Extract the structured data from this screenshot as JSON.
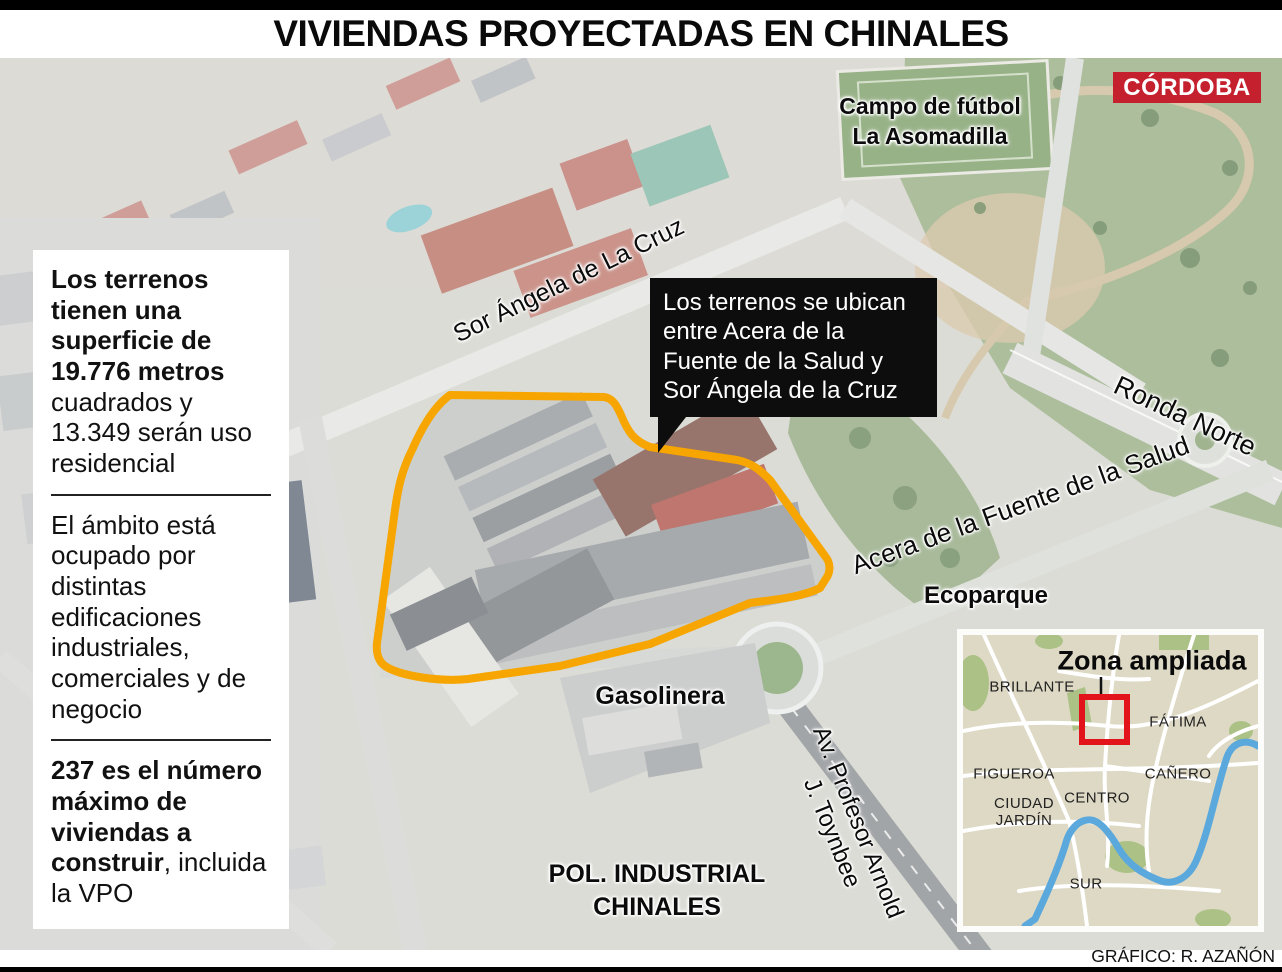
{
  "header": {
    "title": "VIVIENDAS PROYECTADAS EN CHINALES"
  },
  "brand": {
    "name": "CÓRDOBA",
    "bg_color": "#C5202D"
  },
  "info_panel": {
    "surface": {
      "bold": "Los terrenos tienen una superficie de 19.776 metros",
      "regular": " cuadrados y 13.349 serán uso residencial"
    },
    "usage": "El ámbito está ocupado por distintas edificaciones industriales, comerciales y de negocio",
    "homes": {
      "bold": "237 es el número máximo de viviendas a construir",
      "regular": ", incluida la VPO"
    }
  },
  "callout": {
    "text": "Los terrenos se ubican entre Acera de la Fuente de la Salud y Sor Ángela de la Cruz"
  },
  "labels": {
    "campo_futbol": "Campo de fútbol\nLa Asomadilla",
    "sor_angela": "Sor Ángela de La Cruz",
    "ronda_norte": "Ronda Norte",
    "acera_salud": "Acera de la Fuente de la Salud",
    "ecoparque": "Ecoparque",
    "gasolinera": "Gasolinera",
    "toynbee": "Av. Profesor Arnold\nJ. Toynbee",
    "pol_industrial": "POL. INDUSTRIAL\nCHINALES"
  },
  "inset": {
    "title": "Zona ampliada",
    "districts": [
      "BRILLANTE",
      "FÁTIMA",
      "FIGUEROA",
      "CAÑERO",
      "CIUDAD\nJARDÍN",
      "CENTRO",
      "SUR"
    ]
  },
  "credit": {
    "text": "GRÁFICO: R. AZAÑÓN"
  },
  "colors": {
    "highlight_outline": "#F7A500",
    "marker_red": "#E3131B",
    "river_blue": "#5AA8DC",
    "inset_land": "#DED9C4"
  }
}
